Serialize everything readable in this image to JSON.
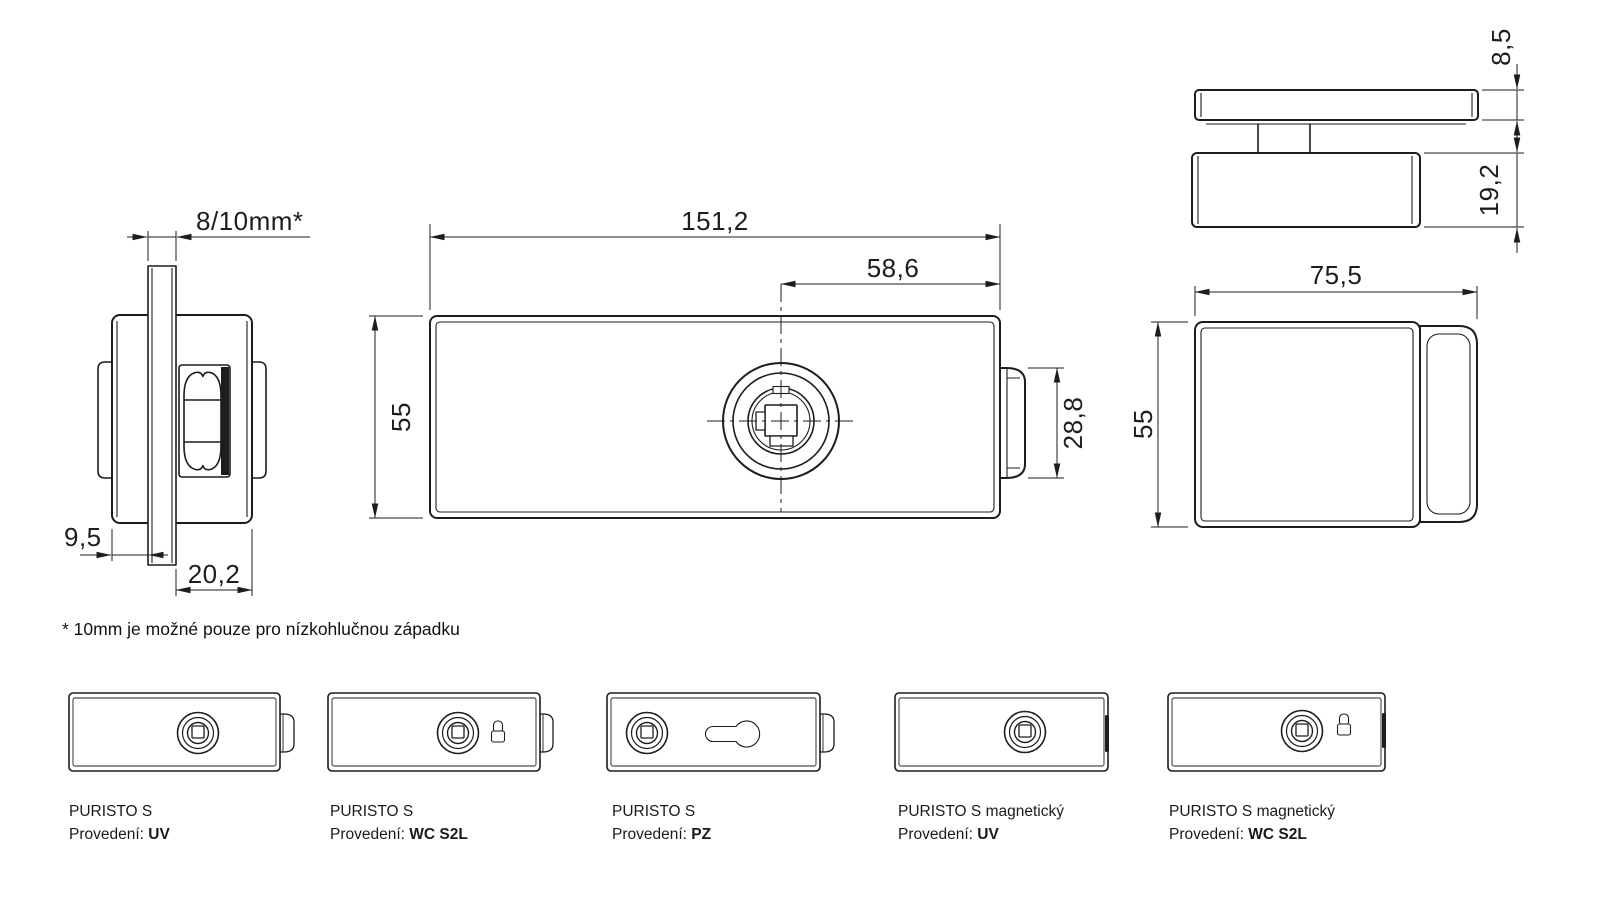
{
  "product": "PURISTO S",
  "views": {
    "side": {
      "dim_glass": "8/10mm*",
      "dim_offset": "9,5",
      "dim_depth": "20,2"
    },
    "front": {
      "dim_width": "151,2",
      "dim_center_offset": "58,6",
      "dim_height": "55",
      "dim_latch": "28,8"
    },
    "top": {
      "dim_plate": "8,5",
      "dim_body": "19,2"
    },
    "end": {
      "dim_width": "75,5",
      "dim_height": "55"
    }
  },
  "note": "* 10mm je možné pouze pro nízkohlučnou západku",
  "variants": [
    {
      "name": "PURISTO S",
      "finish_label": "Provedení:",
      "finish": "UV"
    },
    {
      "name": "PURISTO S",
      "finish_label": "Provedení:",
      "finish": "WC S2L"
    },
    {
      "name": "PURISTO S",
      "finish_label": "Provedení:",
      "finish": "PZ"
    },
    {
      "name": "PURISTO S magnetický",
      "finish_label": "Provedení:",
      "finish": "UV"
    },
    {
      "name": "PURISTO S magnetický",
      "finish_label": "Provedení:",
      "finish": "WC S2L"
    }
  ],
  "colors": {
    "ink": "#1d1d1b",
    "background": "#ffffff"
  }
}
